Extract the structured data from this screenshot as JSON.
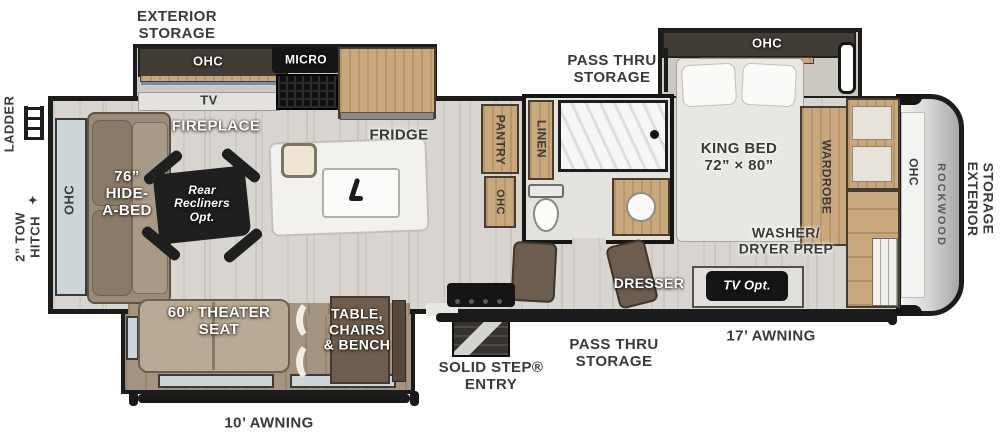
{
  "title": "Rockwood fifth wheel RV floor plan",
  "icons": {
    "hitch": "✦"
  },
  "labels": {
    "exterior": {
      "ladder": "LADDER",
      "tow_hitch": "2” TOW\nHITCH",
      "storage_top": "EXTERIOR\nSTORAGE",
      "storage_front": "EXTERIOR\nSTORAGE",
      "pass_thru_top": "PASS THRU\nSTORAGE",
      "pass_thru_bottom": "PASS THRU\nSTORAGE",
      "awning_17": "17’ AWNING",
      "awning_10": "10’ AWNING",
      "entry": "SOLID STEP®\nENTRY",
      "brand": "ROCKWOOD"
    },
    "living": {
      "ohc_rear": "OHC",
      "hide_a_bed": "76”\nHIDE-\nA-BED",
      "recliners": "Rear\nRecliners\nOpt.",
      "theater_seat": "60” THEATER\nSEAT",
      "dinette": "TABLE,\nCHAIRS\n& BENCH",
      "tv": "TV",
      "fireplace": "FIREPLACE",
      "ohc_kitchen": "OHC"
    },
    "kitchen": {
      "micro": "MICRO",
      "fridge": "FRIDGE",
      "pantry": "PANTRY",
      "ohc_bath_side": "OHC"
    },
    "bath": {
      "linen": "LINEN"
    },
    "bedroom": {
      "ohc": "OHC",
      "king_bed": "KING BED\n72” × 80”",
      "wardrobe": "WARDROBE",
      "washer_dryer": "WASHER/\nDRYER PREP",
      "dresser": "DRESSER",
      "tv_opt": "TV Opt.",
      "ohc_front": "OHC"
    }
  },
  "colors": {
    "wall": "#1c1c1c",
    "floor": "#d8d5d0",
    "slide_floor": "#a5947f",
    "wood": "#c9a87c",
    "appliance_black": "#151515"
  }
}
